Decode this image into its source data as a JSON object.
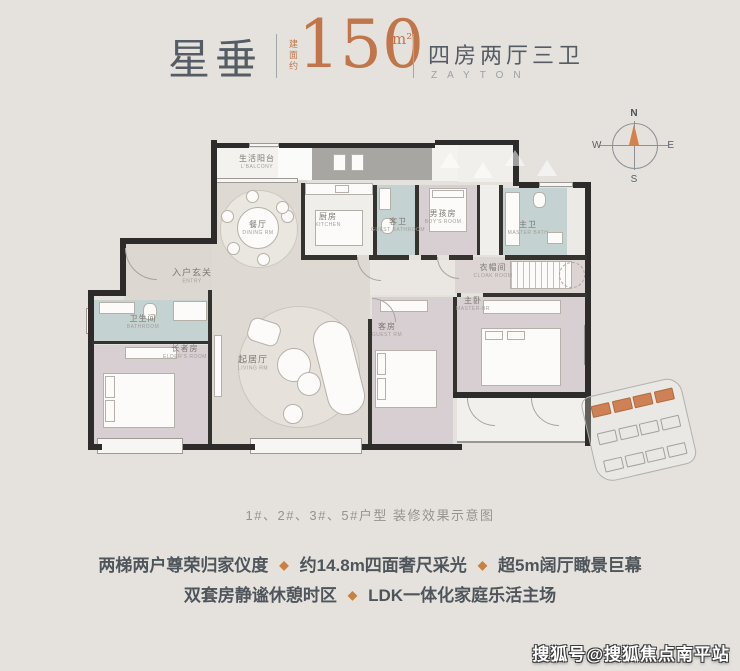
{
  "header": {
    "name": "星垂",
    "area_label": "建面约",
    "area_value": "150",
    "area_unit": "m²",
    "layout_title": "四房两厅三卫",
    "layout_subtitle": "ZAYTON"
  },
  "compass": {
    "north": "N",
    "south": "S",
    "east": "E",
    "west": "W"
  },
  "floorplan": {
    "rooms": [
      {
        "key": "life-balcony",
        "zh": "生活阳台",
        "en": "L'BALCONY"
      },
      {
        "key": "dining",
        "zh": "餐厅",
        "en": "DINING RM"
      },
      {
        "key": "kitchen",
        "zh": "厨房",
        "en": "KITCHEN"
      },
      {
        "key": "guest-bath",
        "zh": "客卫",
        "en": "GUEST BATHROOM"
      },
      {
        "key": "boy-room",
        "zh": "男孩房",
        "en": "BOY'S ROOM"
      },
      {
        "key": "master-bath",
        "zh": "主卫",
        "en": "MASTER BATH"
      },
      {
        "key": "entry-foyer",
        "zh": "入户玄关",
        "en": "ENTRY"
      },
      {
        "key": "bathroom",
        "zh": "卫生间",
        "en": "BATHROOM"
      },
      {
        "key": "elder-room",
        "zh": "长者房",
        "en": "ELDER'S ROOM"
      },
      {
        "key": "living",
        "zh": "起居厅",
        "en": "LIVING RM"
      },
      {
        "key": "guest-room",
        "zh": "客房",
        "en": "GUEST RM"
      },
      {
        "key": "master-bedroom",
        "zh": "主卧",
        "en": "MASTER-BR"
      },
      {
        "key": "cloak-room",
        "zh": "衣帽间",
        "en": "CLOAK ROOM"
      }
    ]
  },
  "caption": "1#、2#、3#、5#户型 装修效果示意图",
  "features": {
    "separator_icon": "◆",
    "line1": [
      "两梯两户尊荣归家仪度",
      "约14.8m四面奢尺采光",
      "超5m阔厅瞰景巨幕"
    ],
    "line2": [
      "双套房静谧休憩时区",
      "LDK一体化家庭乐活主场"
    ]
  },
  "watermark": "搜狐号@搜狐焦点南平站",
  "colors": {
    "accent_orange": "#c0764a",
    "title_gray": "#555c64",
    "wall_dark": "#2d2c2a",
    "bath_blue": "#c5d2d2",
    "bedroom_mauve": "#d8cfd3",
    "floor_warm": "#ded9d2"
  }
}
